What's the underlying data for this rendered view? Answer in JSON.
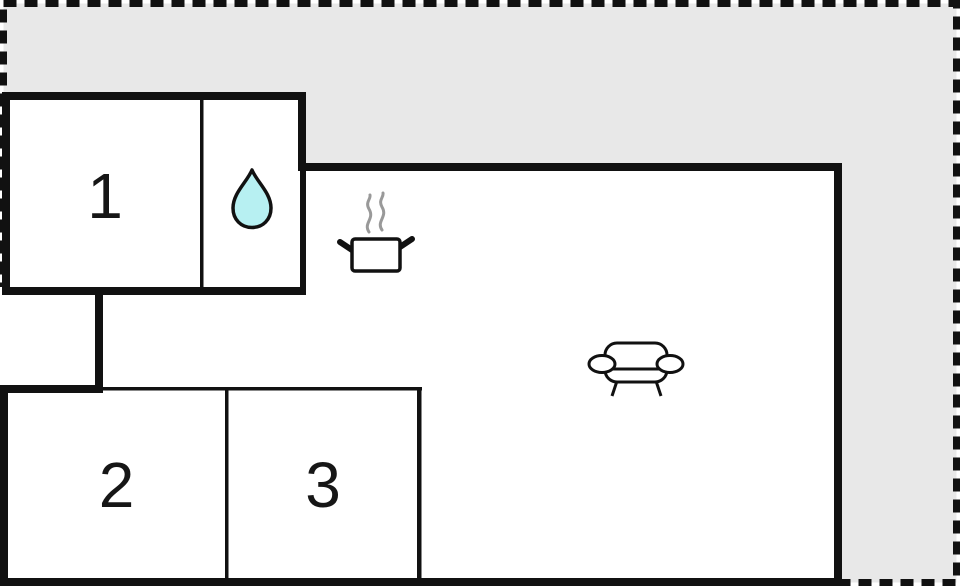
{
  "floor_plan": {
    "rooms": [
      {
        "id": "room-1",
        "label": "1"
      },
      {
        "id": "room-2",
        "label": "2"
      },
      {
        "id": "room-3",
        "label": "3"
      }
    ],
    "icons": [
      {
        "name": "water-drop-icon"
      },
      {
        "name": "cooking-pot-icon"
      },
      {
        "name": "steam-icon"
      },
      {
        "name": "sofa-icon"
      }
    ],
    "colors": {
      "outside_fill": "#e8e8e8",
      "wall": "#111111",
      "room_fill": "#ffffff",
      "water_drop_fill": "#b7f0f2",
      "steam": "#999999"
    }
  }
}
